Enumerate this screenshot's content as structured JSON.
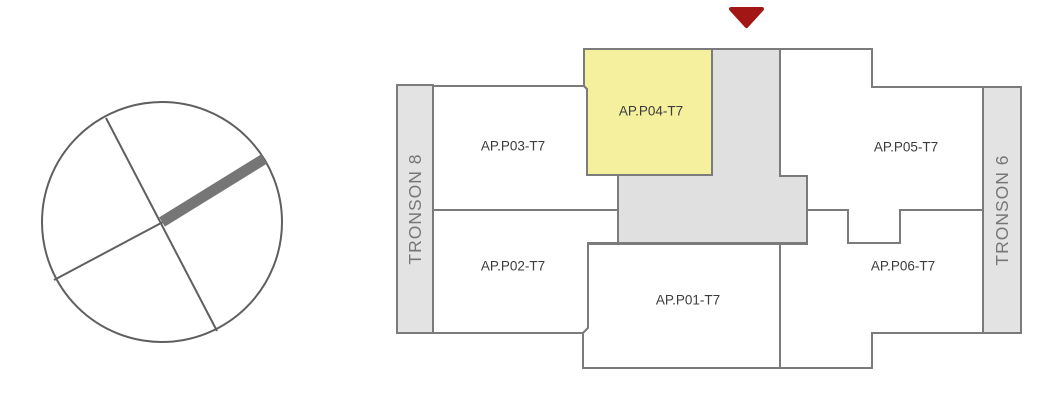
{
  "colors": {
    "highlight_fill": "#f5f09e",
    "room_fill": "#ffffff",
    "core_fill": "#e0e0e0",
    "bar_fill": "#e3e3e3",
    "outline": "#7b7b7b",
    "marker_red": "#a31616",
    "label_text": "#3c3c3c",
    "tronson_text": "#777777",
    "compass_stroke": "#5f5f5f",
    "compass_needle": "#767676"
  },
  "floorplan": {
    "rooms": [
      {
        "id": "p01",
        "label": "AP.P01-T7",
        "highlighted": false
      },
      {
        "id": "p02",
        "label": "AP.P02-T7",
        "highlighted": false
      },
      {
        "id": "p03",
        "label": "AP.P03-T7",
        "highlighted": false
      },
      {
        "id": "p04",
        "label": "AP.P04-T7",
        "highlighted": true
      },
      {
        "id": "p05",
        "label": "AP.P05-T7",
        "highlighted": false
      },
      {
        "id": "p06",
        "label": "AP.P06-T7",
        "highlighted": false
      }
    ],
    "tronsons": [
      {
        "id": "t8",
        "label": "TRONSON 8"
      },
      {
        "id": "t6",
        "label": "TRONSON 6"
      }
    ]
  }
}
